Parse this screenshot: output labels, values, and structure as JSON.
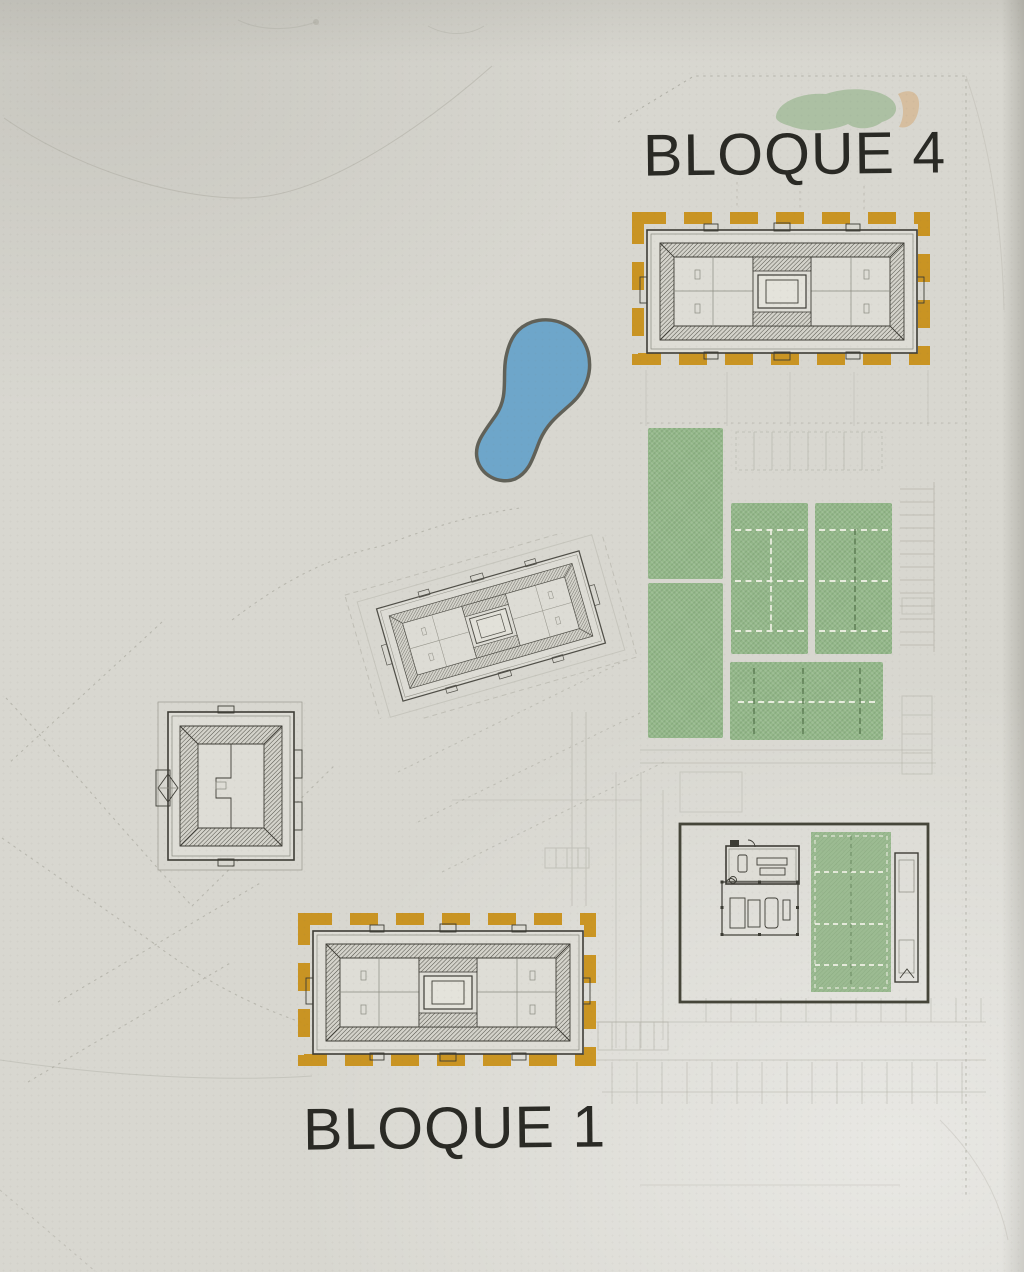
{
  "labels": {
    "bloque4": "BLOQUE 4",
    "bloque1": "BLOQUE 1"
  },
  "colors": {
    "paper": "#d8d7d0",
    "paper_bright": "#e4e3db",
    "building_fill": "#deddd6",
    "ink": "#3e3d36",
    "ink_soft": "#8b8a80",
    "context_line": "#abaaa0",
    "label_text": "#2a2a25",
    "highlight_orange": "#c88e13",
    "court_green": "#94b88a",
    "court_line_white": "#eef0e4",
    "court_line_dark": "#5d7d54",
    "water_blue": "#69a4ca",
    "water_outline": "#5b5b52",
    "vegetation_green": "#a8be9e",
    "sand_tan": "#d6bd9c",
    "club_border": "#454539"
  },
  "features": {
    "highlighted_blocks": [
      "bloque-4-building",
      "bloque-1-building"
    ],
    "other_buildings": [
      "central-rotated-building",
      "west-square-building",
      "clubhouse-compound"
    ],
    "amenities": [
      "pond",
      "lawn-courts",
      "padel-courts",
      "clubhouse-court"
    ],
    "vegetation": [
      "tree-canopy",
      "sand-patch"
    ]
  }
}
